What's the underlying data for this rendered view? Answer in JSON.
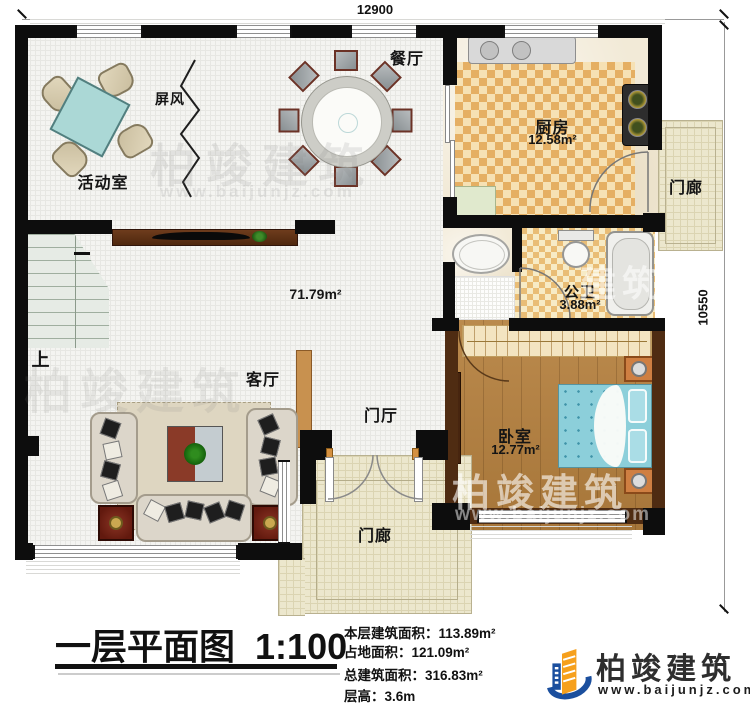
{
  "plan": {
    "dim_top": "12900",
    "dim_right": "10550",
    "rooms": {
      "activity": "活动室",
      "screen": "屏风",
      "dining": "餐厅",
      "kitchen": "厨房",
      "kitchen_area": "12.58m²",
      "porch_right": "门廊",
      "bath": "公卫",
      "bath_area": "3.88m²",
      "bedroom": "卧室",
      "bedroom_area": "12.77m²",
      "living": "客厅",
      "foyer": "门厅",
      "hall_area": "71.79m²",
      "stairs_up": "上",
      "porch_bottom": "门廊"
    }
  },
  "watermarks": {
    "brand": "柏竣建筑",
    "url": "www.baijunjz.com",
    "partial": "建筑"
  },
  "title_block": {
    "title": "一层平面图",
    "scale": "1:100",
    "stats": [
      {
        "label": "本层建筑面积：",
        "value": "113.89m²"
      },
      {
        "label": "占地面积：",
        "value": "121.09m²"
      },
      {
        "label": "总建筑面积：",
        "value": "316.83m²"
      },
      {
        "label": "层高：",
        "value": "3.6m"
      }
    ]
  },
  "logo": {
    "name": "柏竣建筑",
    "url": "www.baijunjz.com"
  },
  "colors": {
    "accent_blue": "#1b4f9e",
    "accent_orange": "#f6a01d",
    "wall": "#0d0d0d"
  }
}
